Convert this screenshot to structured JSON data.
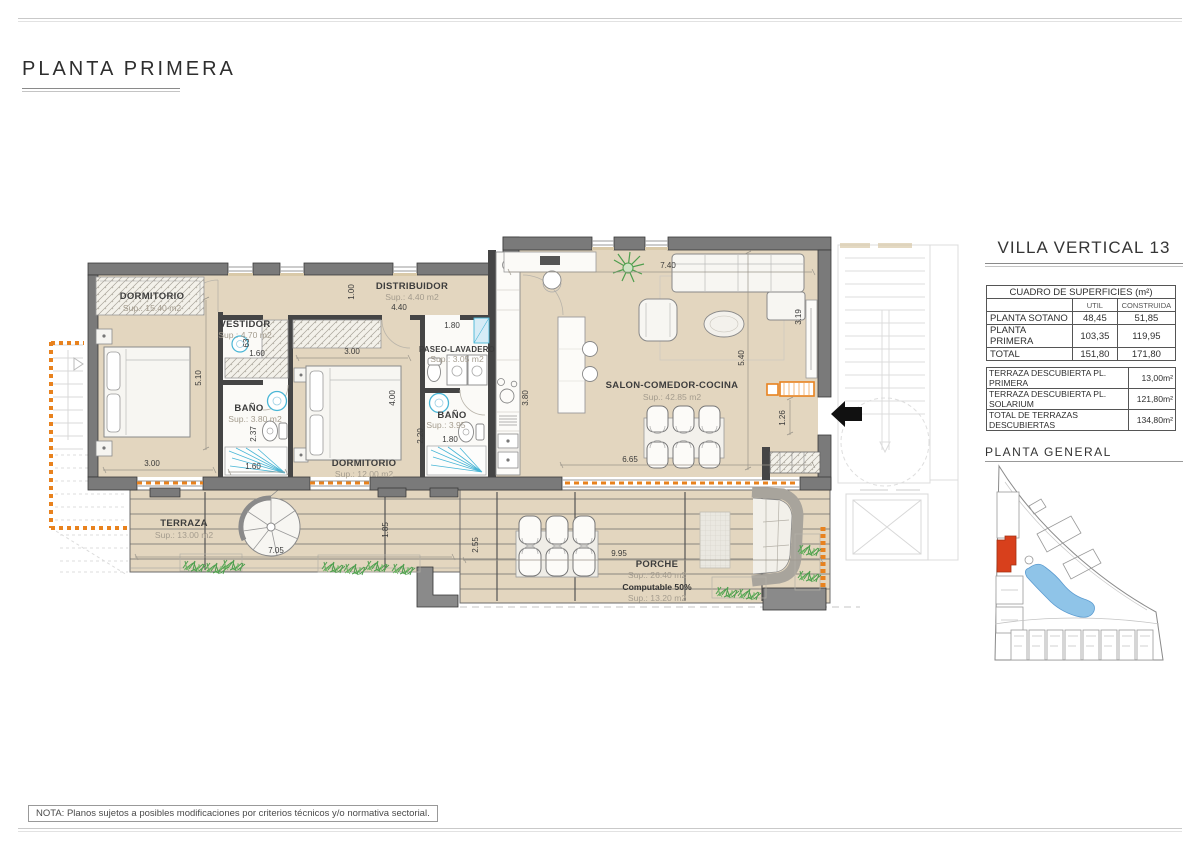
{
  "page": {
    "title": "PLANTA PRIMERA",
    "note": "NOTA: Planos sujetos a posibles modificaciones por criterios técnicos y/o normativa sectorial."
  },
  "right_panel": {
    "villa_title": "VILLA VERTICAL 13",
    "surfaces_table": {
      "title": "CUADRO DE SUPERFICIES (m²)",
      "col_util": "UTIL",
      "col_construida": "CONSTRUIDA",
      "rows": [
        {
          "label": "PLANTA SOTANO",
          "util": "48,45",
          "construida": "51,85"
        },
        {
          "label": "PLANTA PRIMERA",
          "util": "103,35",
          "construida": "119,95"
        },
        {
          "label": "TOTAL",
          "util": "151,80",
          "construida": "171,80"
        }
      ]
    },
    "terraces_table": {
      "rows": [
        {
          "label": "TERRAZA DESCUBIERTA PL. PRIMERA",
          "value": "13,00m²"
        },
        {
          "label": "TERRAZA DESCUBIERTA PL. SOLARIUM",
          "value": "121,80m²"
        },
        {
          "label": "TOTAL DE TERRAZAS DESCUBIERTAS",
          "value": "134,80m²"
        }
      ]
    },
    "site_plan_title": "PLANTA GENERAL"
  },
  "floor_plan": {
    "rooms": [
      {
        "name": "DORMITORIO",
        "sup": "Sup.: 15.40  m2"
      },
      {
        "name": "VESTIDOR",
        "sup": "Sup.: 4.70  m2"
      },
      {
        "name": "BAÑO",
        "sup": "Sup.:  3.80    m2"
      },
      {
        "name": "DORMITORIO",
        "sup": "Sup.: 12.00  m2"
      },
      {
        "name": "DISTRIBUIDOR",
        "sup": "Sup.: 4.40   m2"
      },
      {
        "name": "PASEO-LAVADERO",
        "sup": "Sup.:  3.05   m2"
      },
      {
        "name": "BAÑO",
        "sup": "Sup.:  3.95",
        "sup2": "m2"
      },
      {
        "name": "SALON-COMEDOR-COCINA",
        "sup": "Sup.: 42.85  m2"
      },
      {
        "name": "TERRAZA",
        "sup": "Sup.: 13.00  m2"
      },
      {
        "name": "PORCHE",
        "sup": "Sup.: 26.40  m2",
        "computable": "Computable 50%",
        "computable_sup": "Sup.: 13.20  m2"
      }
    ],
    "dims": [
      "5.10",
      "3.00",
      "1.60",
      "2.37",
      "1.60",
      "63",
      "3.00",
      "4.00",
      "2.20",
      "1.80",
      "1.80",
      "4.40",
      "1.00",
      "3.80",
      "7.40",
      "5.40",
      "3.19",
      "1.26",
      "6.65",
      "7.05",
      "1.85",
      "2.55",
      "9.95"
    ],
    "colors": {
      "wall_gray": "#7A7A7A",
      "floor_tan": "#E3D6BF",
      "accent_orange": "#E8821E",
      "fixture_blue": "#49B6D6",
      "plant_green": "#4E9E4E",
      "site_red": "#D8401C",
      "pool_blue": "#8FC4E8"
    }
  }
}
